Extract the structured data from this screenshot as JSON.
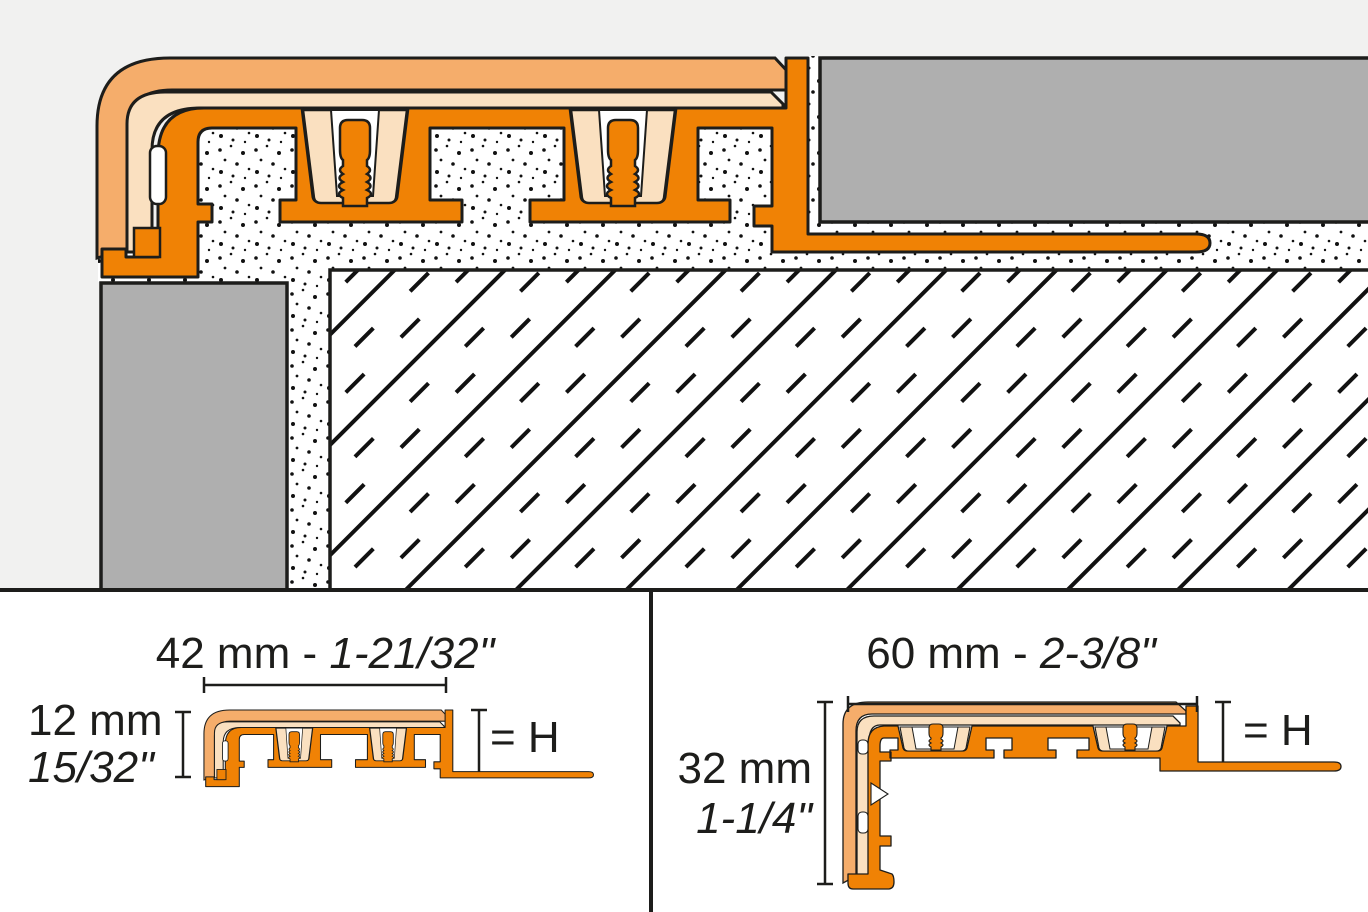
{
  "drawing": {
    "type_label": "profile installation cross-section",
    "colors": {
      "profile_orange": "#F08205",
      "vinyl_outer": "#F5AD6B",
      "vinyl_inner": "#FAE0C0",
      "tile_gray": "#AFAFAF",
      "background_gray": "#F1F1F0",
      "outline": "#1D1D1B"
    }
  },
  "panels": {
    "left": {
      "width_label": {
        "metric": "42 mm",
        "separator": " - ",
        "imperial": "1-21/32\""
      },
      "height_label": {
        "metric": "12 mm",
        "imperial": "15/32\""
      },
      "h_label": "= H"
    },
    "right": {
      "width_label": {
        "metric": "60 mm",
        "separator": " - ",
        "imperial": "2-3/8\""
      },
      "height_label": {
        "metric": "32 mm",
        "imperial": "1-1/4\""
      },
      "h_label": "= H"
    }
  }
}
